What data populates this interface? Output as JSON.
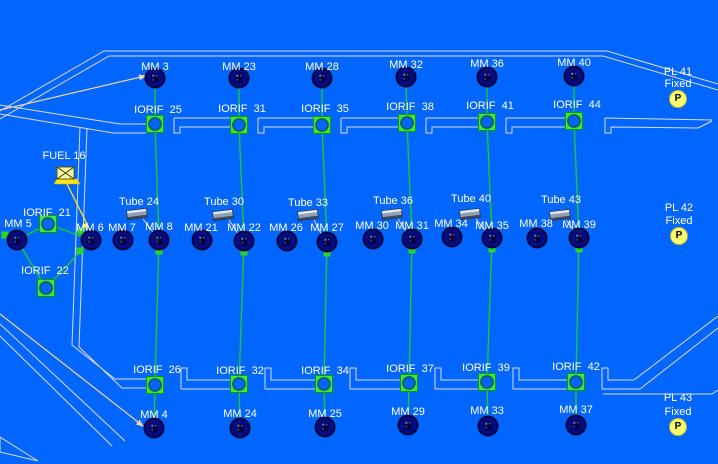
{
  "canvas": {
    "background_color": "#0066FF",
    "structure_line_color": "#DBDBDB",
    "connection_line_color": "#17C837",
    "node_fill_color": "#000D86",
    "marker_yellow": "#FFFF70",
    "fuel_yellow": "#FFE41E",
    "leader_arrow_color": "#EDD5A0"
  },
  "symbols": {
    "mm_node": "round-sensor-node-icon",
    "iorif": "orifice-square-icon",
    "tube": "tube-cylinder-icon",
    "pl_marker": "fixed-point-p-marker-icon",
    "fuel_valve": "fuel-valve-icon"
  },
  "top_mm": [
    "MM 3",
    "MM 23",
    "MM 28",
    "MM 32",
    "MM 36",
    "MM 40"
  ],
  "top_iorif": [
    "IORIF  25",
    "IORIF  31",
    "IORIF  35",
    "IORIF  38",
    "IORIF  41",
    "IORIF  44"
  ],
  "tubes": [
    "Tube 24",
    "Tube 30",
    "Tube 33",
    "Tube 36",
    "Tube 40",
    "Tube 43"
  ],
  "mid_mm": [
    "MM 5",
    "MM 6",
    "MM 7",
    "MM 8",
    "MM 21",
    "MM 22",
    "MM 26",
    "MM 27",
    "MM 30",
    "MM 31",
    "MM 34",
    "MM 35",
    "MM 38",
    "MM 39"
  ],
  "bottom_iorif": [
    "IORIF  26",
    "IORIF  32",
    "IORIF  34",
    "IORIF  37",
    "IORIF  39",
    "IORIF  42"
  ],
  "bottom_mm": [
    "MM 4",
    "MM 24",
    "MM 25",
    "MM 29",
    "MM 33",
    "MM 37"
  ],
  "left_iorif": [
    "IORIF  21",
    "IORIF  22"
  ],
  "fuel": {
    "label": "FUEL 16"
  },
  "pl_markers": [
    {
      "name": "PL 41",
      "state": "Fixed",
      "symbol": "P"
    },
    {
      "name": "PL 42",
      "state": "Fixed",
      "symbol": "P"
    },
    {
      "name": "PL 43",
      "state": "Fixed",
      "symbol": "P"
    }
  ]
}
